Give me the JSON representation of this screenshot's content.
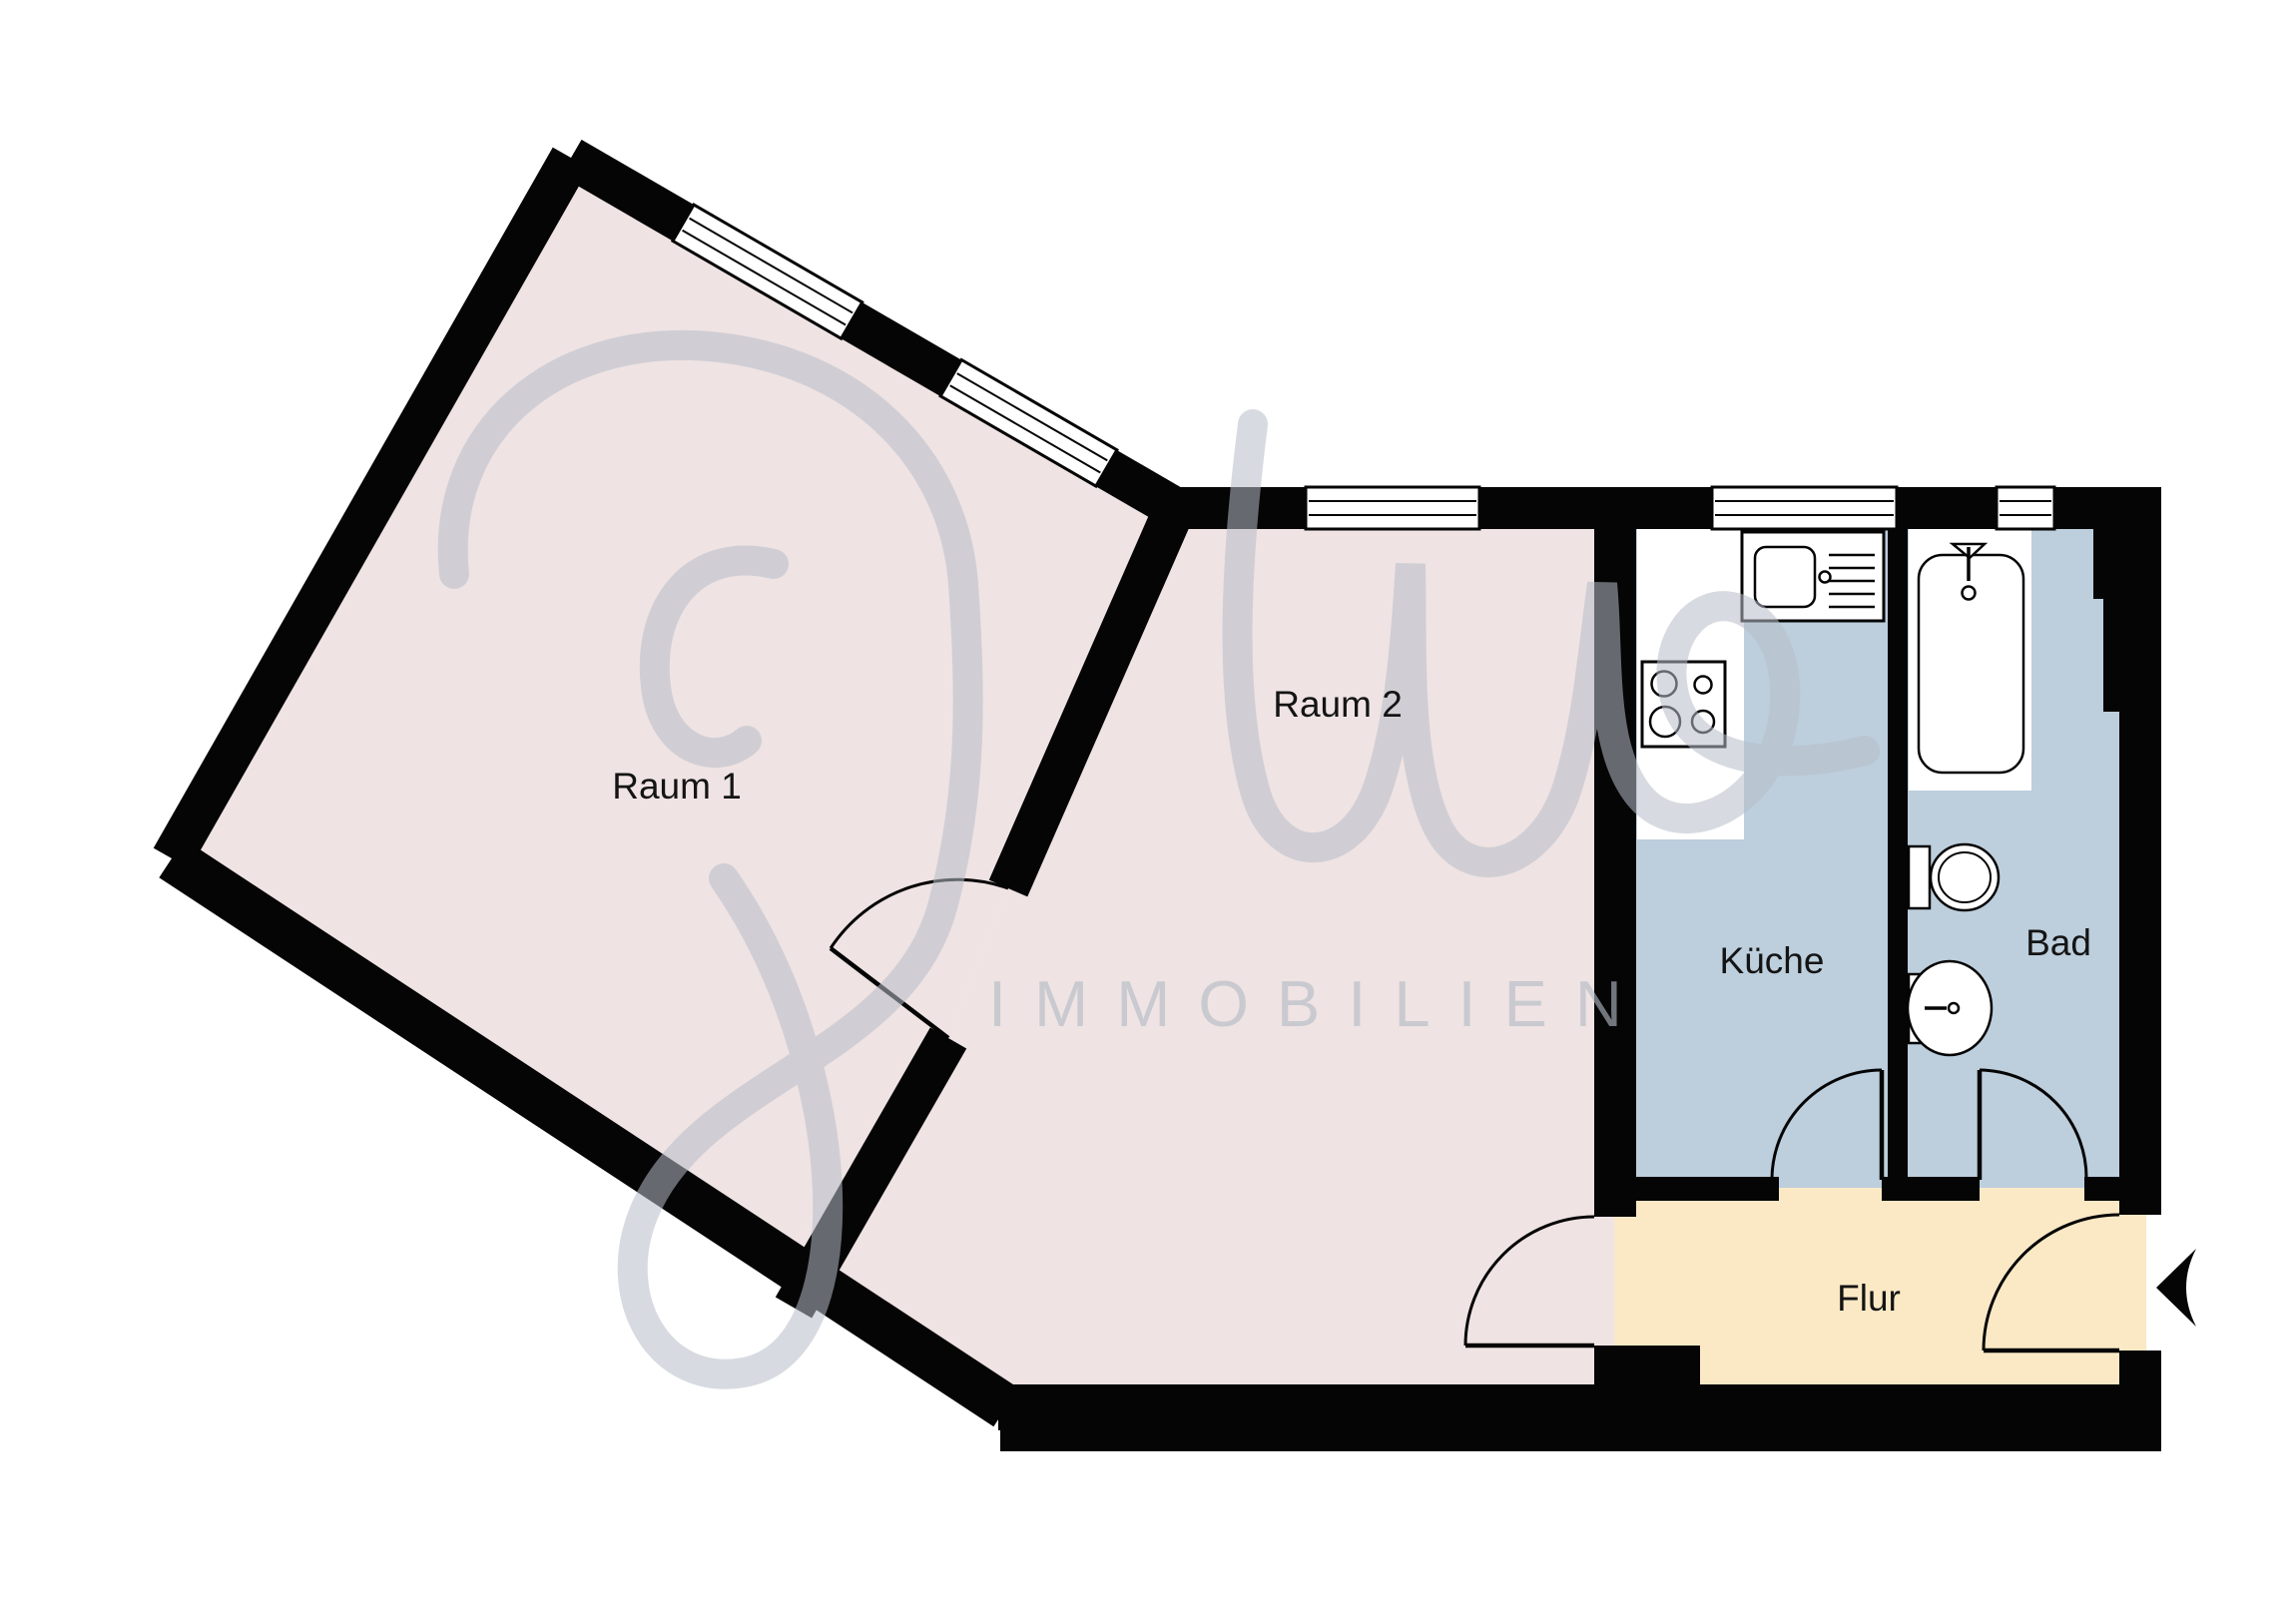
{
  "plan": {
    "type": "apartment-floorplan",
    "rooms": {
      "raum1": {
        "label": "Raum 1"
      },
      "raum2": {
        "label": "Raum 2"
      },
      "kueche": {
        "label": "Küche"
      },
      "bad": {
        "label": "Bad"
      },
      "flur": {
        "label": "Flur"
      }
    },
    "watermark": {
      "script": "Juno",
      "caps": "IMMOBILIEN"
    },
    "colors": {
      "room_floor": "#EFE3E3",
      "wet_room_floor": "#BDCEDC",
      "hall_floor": "#FBE9C6",
      "wall": "#050505",
      "watermark": "#B6BDC8"
    },
    "fixtures": [
      "kitchen-sink-counter",
      "stove-4-burners",
      "bathtub",
      "toilet",
      "washbasin"
    ],
    "doors": [
      "raum1-raum2-door",
      "raum2-flur-door",
      "kueche-flur-door",
      "bad-flur-door",
      "entrance-door"
    ],
    "windows": [
      "raum1-window-1",
      "raum1-window-2",
      "raum2-window",
      "kueche-window",
      "bad-window"
    ]
  }
}
